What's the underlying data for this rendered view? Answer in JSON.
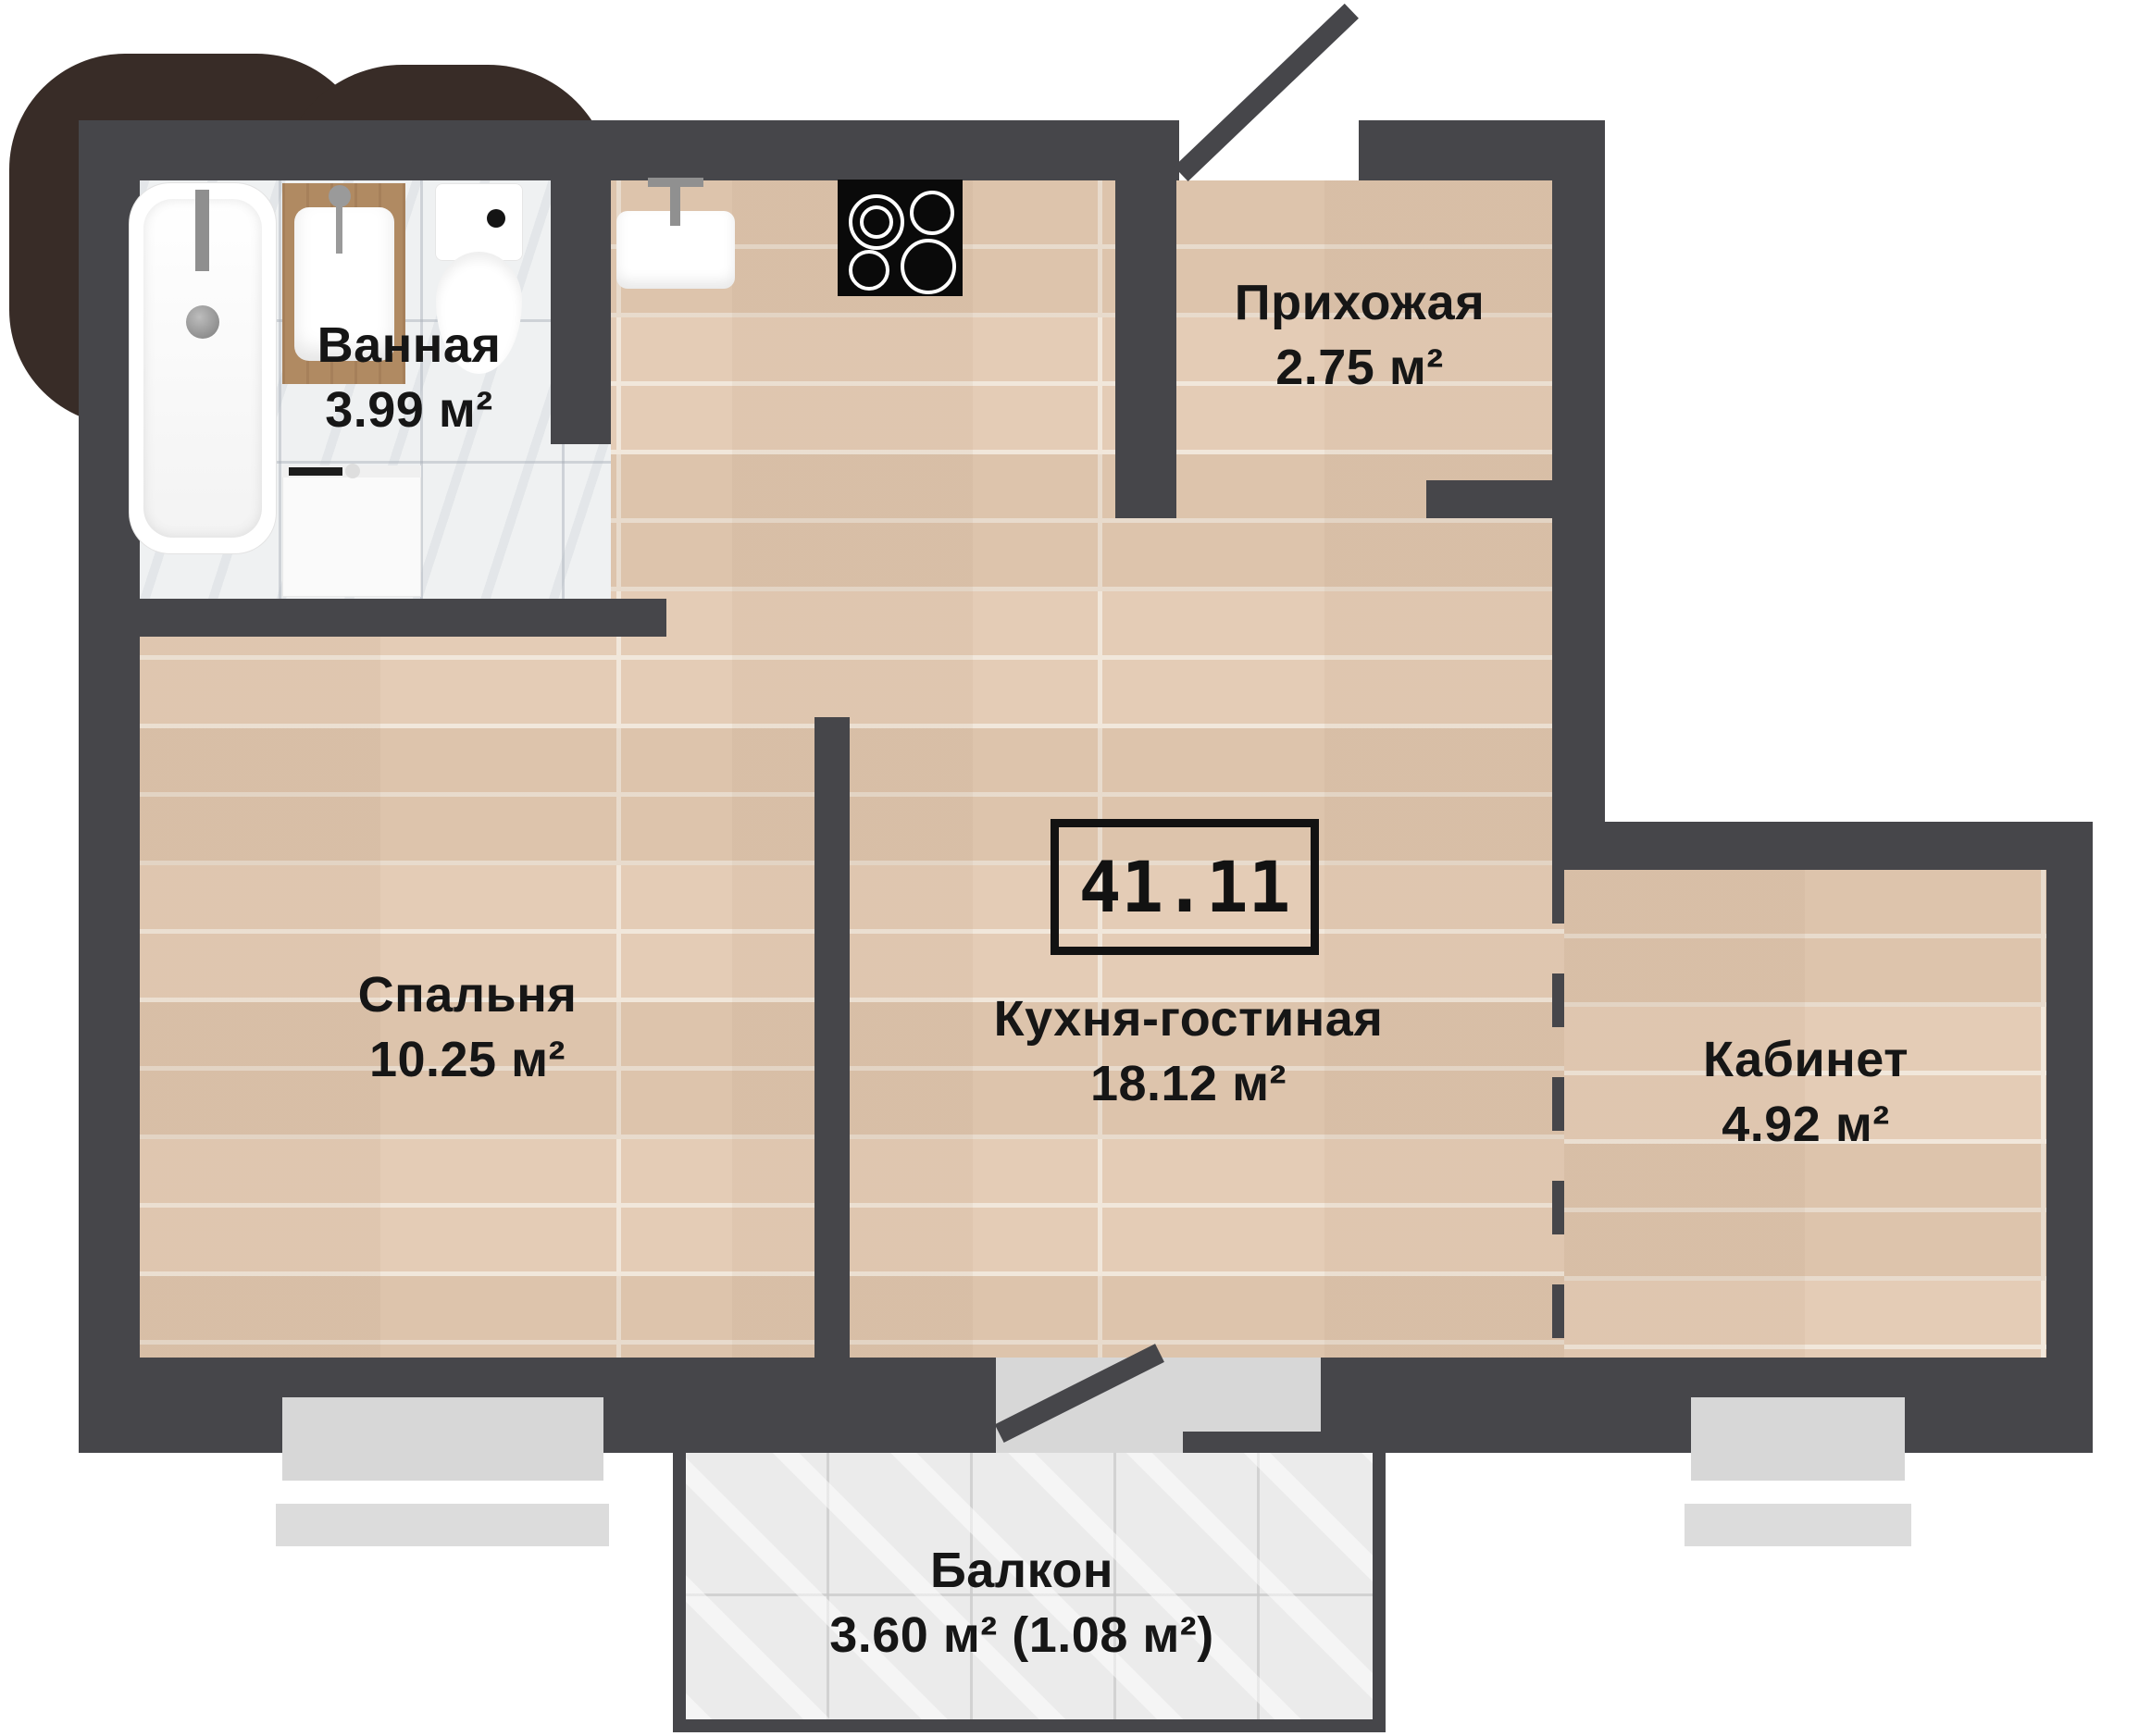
{
  "plan": {
    "title_box": {
      "total_area": "41.11"
    },
    "rooms": [
      {
        "id": "bathroom",
        "name": "Ванная",
        "area": "3.99 м²"
      },
      {
        "id": "hallway",
        "name": "Прихожая",
        "area": "2.75 м²"
      },
      {
        "id": "bedroom",
        "name": "Спальня",
        "area": "10.25 м²"
      },
      {
        "id": "kitchen_living",
        "name": "Кухня-гостиная",
        "area": "18.12 м²"
      },
      {
        "id": "office",
        "name": "Кабинет",
        "area": "4.92 м²"
      },
      {
        "id": "balcony",
        "name": "Балкон",
        "area": "3.60 м² (1.08 м²)"
      }
    ],
    "fixtures": [
      "bathtub",
      "bathroom-sink-counter",
      "toilet",
      "washing-machine",
      "kitchen-sink",
      "stove"
    ],
    "colors": {
      "wall": "#46464a",
      "wood_floor": "#e4ccb6",
      "marble_floor": "#eff1f2",
      "balcony_tile": "#ebebeb",
      "background_blob": "#382c27",
      "window_glass": "#d7d7d7",
      "label_text": "#161616",
      "counter_wood": "#b08a62",
      "stove": "#0a0a0a"
    }
  }
}
